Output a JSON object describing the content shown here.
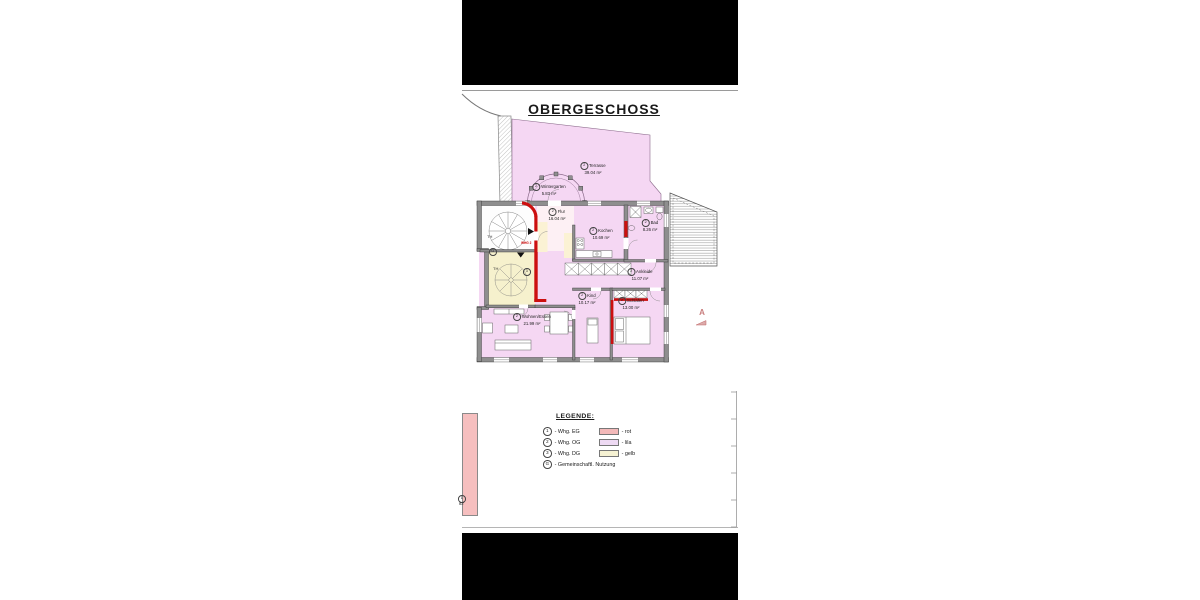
{
  "title": "OBERGESCHOSS",
  "rooms": [
    {
      "num": "2",
      "name": "Terrasse",
      "area": "39.04 m²"
    },
    {
      "num": "2",
      "name": "Wintergarten",
      "area": "5.83 m²"
    },
    {
      "num": "2",
      "name": "Flur",
      "area": "16.04 m²"
    },
    {
      "num": "2",
      "name": "Kochen",
      "area": "10.69 m²"
    },
    {
      "num": "2",
      "name": "Bad",
      "area": "8.26 m²"
    },
    {
      "num": "2",
      "name": "Ankleide",
      "area": "11.07 m²"
    },
    {
      "num": "2",
      "name": "Kind",
      "area": "10.17 m²"
    },
    {
      "num": "2",
      "name": "Schlafen",
      "area": "13.00 m²"
    },
    {
      "num": "2",
      "name": "Wohnen/Essen",
      "area": "21.99 m²"
    }
  ],
  "markers": {
    "stairwell_top": {
      "label": "TH",
      "circle": "G"
    },
    "stairwell_bottom": {
      "label": "TH",
      "circle": "3"
    },
    "apartment_entry": "WHG 2",
    "section_letter": "A",
    "eg_fragment": {
      "circle": "1",
      "label": "ST"
    }
  },
  "legend": {
    "heading": "LEGENDE:",
    "items": [
      {
        "num": "1",
        "label": "- Whg. EG",
        "color_label": "- rot",
        "swatch": "#f3b9b9"
      },
      {
        "num": "2",
        "label": "- Whg. OG",
        "color_label": "- lila",
        "swatch": "#eedaf3"
      },
      {
        "num": "3",
        "label": "- Whg. DG",
        "color_label": "- gelb",
        "swatch": "#f6f2d3"
      },
      {
        "num": "G",
        "label": "- Gemeinschaftl. Nutzung",
        "color_label": "",
        "swatch": ""
      }
    ]
  },
  "colors": {
    "whg_og_fill": "#f5d7f3",
    "whg_dg_fill": "#f6f1cd",
    "whg_eg_fill": "#f6bfbf",
    "partition_red": "#cc0f0f",
    "wall_gray": "#8e8e8e",
    "redaction_bar": "#000000"
  }
}
